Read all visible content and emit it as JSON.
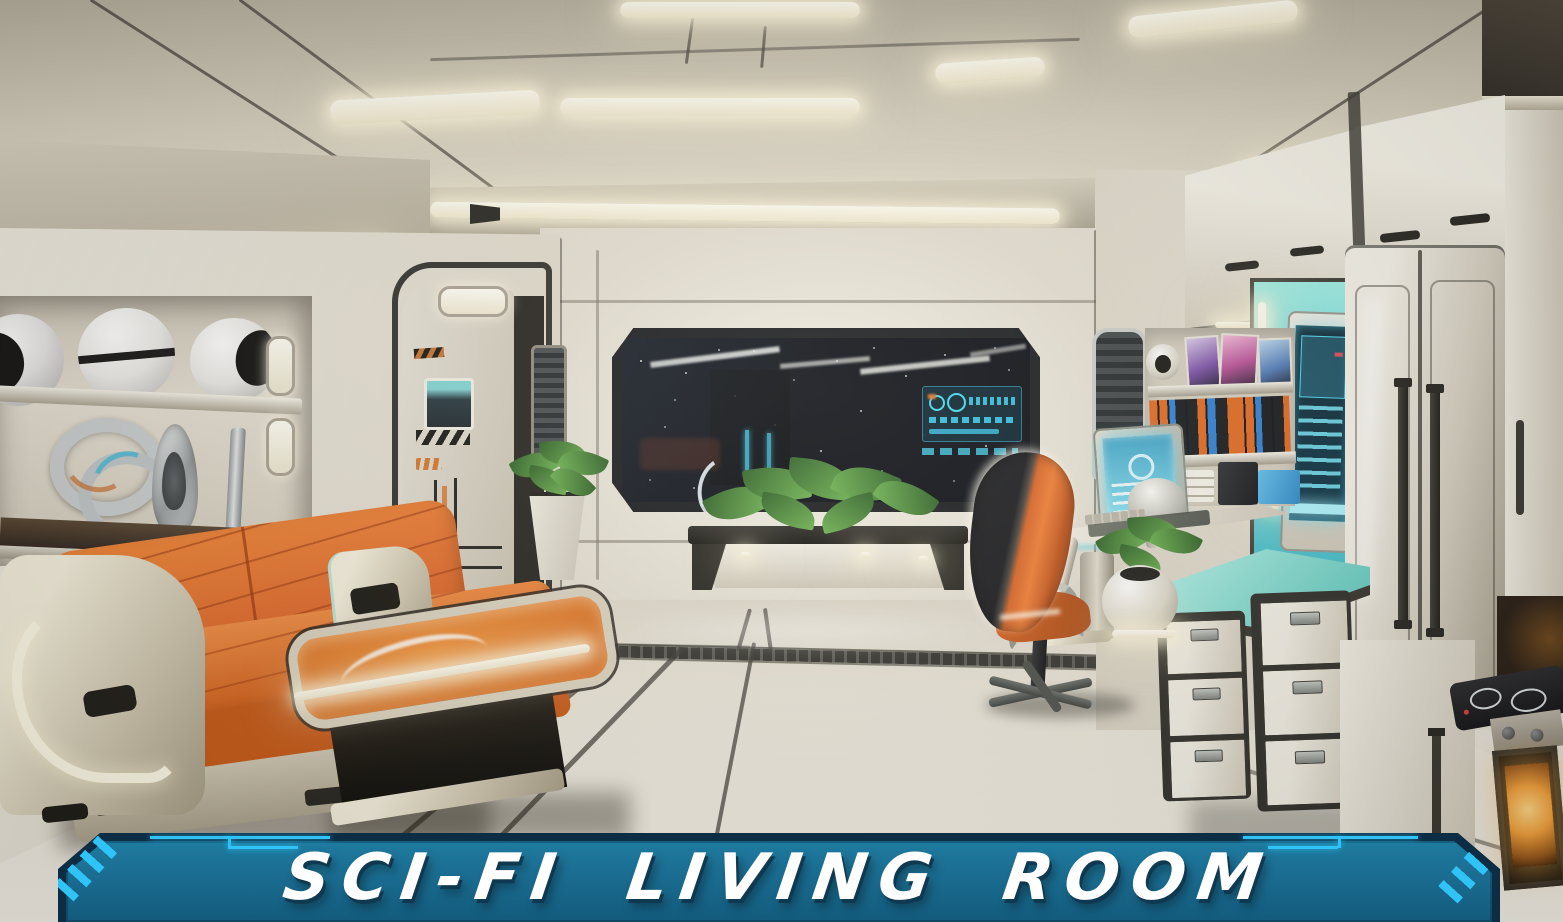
{
  "banner": {
    "title": "SCI-FI LIVING ROOM",
    "colors": {
      "background": "#1a6c90",
      "border": "#0c2d44",
      "accent": "#2fc3f7",
      "text": "#ffffff",
      "text_shadow": "#0e3950"
    }
  },
  "scene": {
    "label": "3D rendered sci-fi living room interior",
    "palette": {
      "ceiling": "#d8d2c2",
      "wall": "#e9e5da",
      "floor": "#ddd7c9",
      "trim_dark": "#2a2a25",
      "sofa_orange": "#e0692a",
      "table_orange": "#d96a1a",
      "frame_cream": "#d9d3c2",
      "counter_teal": "#7fe0d6",
      "alcove_teal": "#5fd3da",
      "screen_cyan": "#3cc9e8",
      "window_dark": "#070a12",
      "led_white": "#fdf8e6",
      "oven_glow": "#f3a03a",
      "book_orange": "#e06820",
      "book_blue": "#2d7fd3",
      "book_black": "#15171b",
      "plant_green": "#3f7d35",
      "chair_orange": "#d96325",
      "metal_gray": "#b9b3a5"
    }
  }
}
